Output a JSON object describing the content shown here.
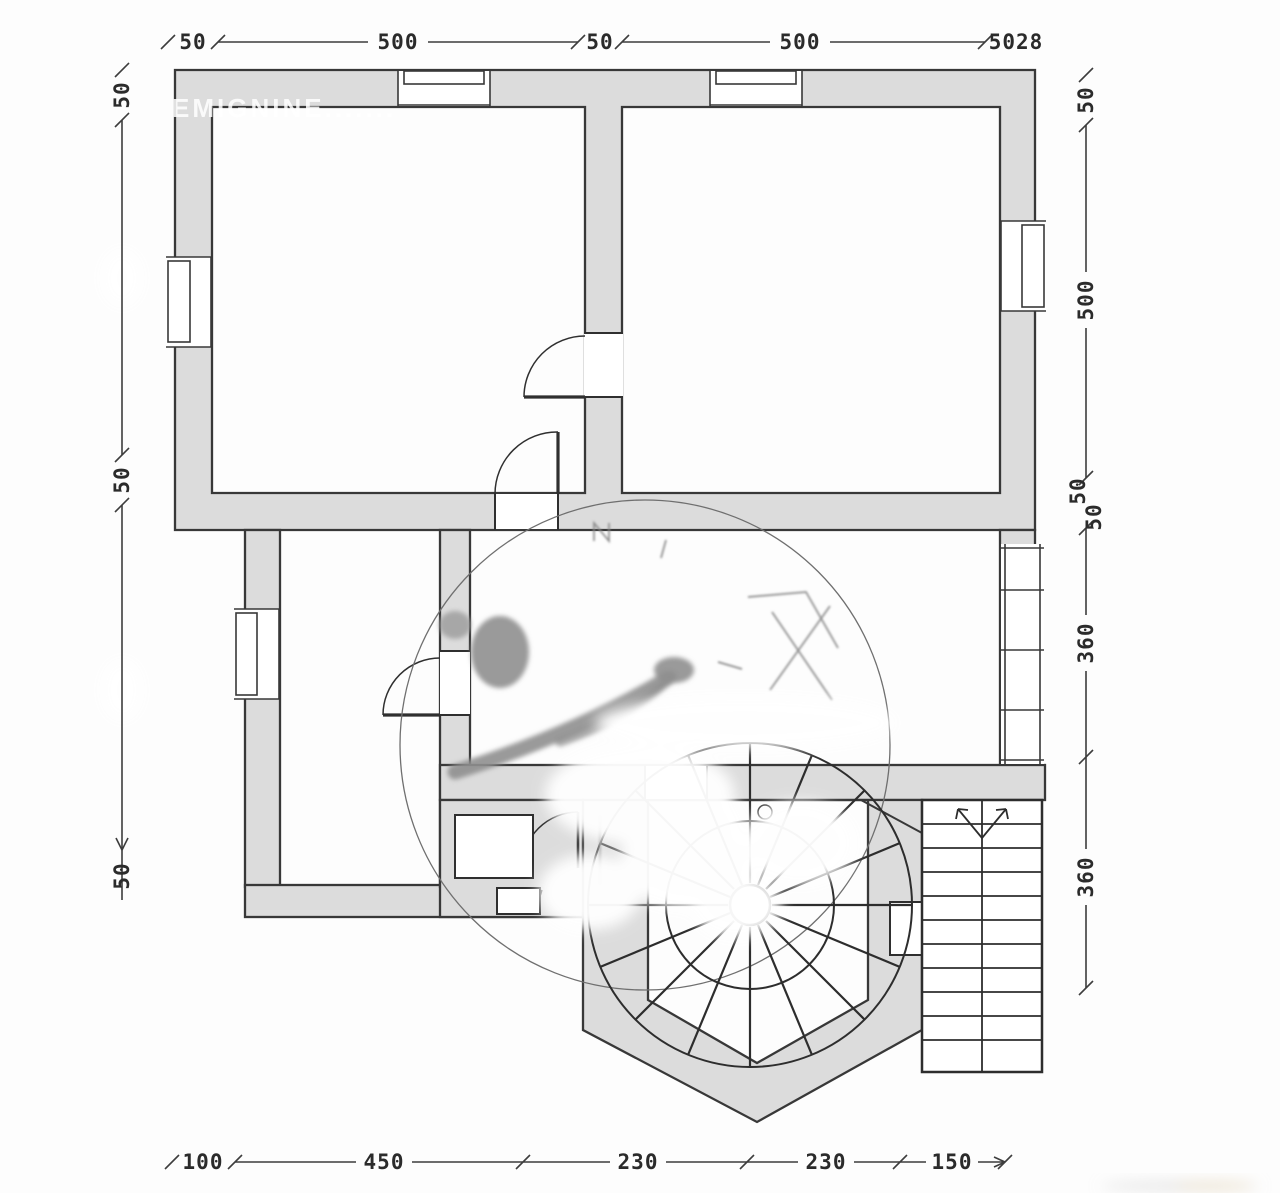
{
  "watermark": {
    "text": "EMIGNINE......."
  },
  "dims": {
    "top": [
      "50",
      "500",
      "50",
      "500",
      "5028"
    ],
    "right": [
      "50",
      "500",
      "50",
      "50",
      "360",
      "360"
    ],
    "left": [
      "50",
      "50",
      "50"
    ],
    "bottom": [
      "100",
      "450",
      "230",
      "230",
      "150"
    ]
  }
}
